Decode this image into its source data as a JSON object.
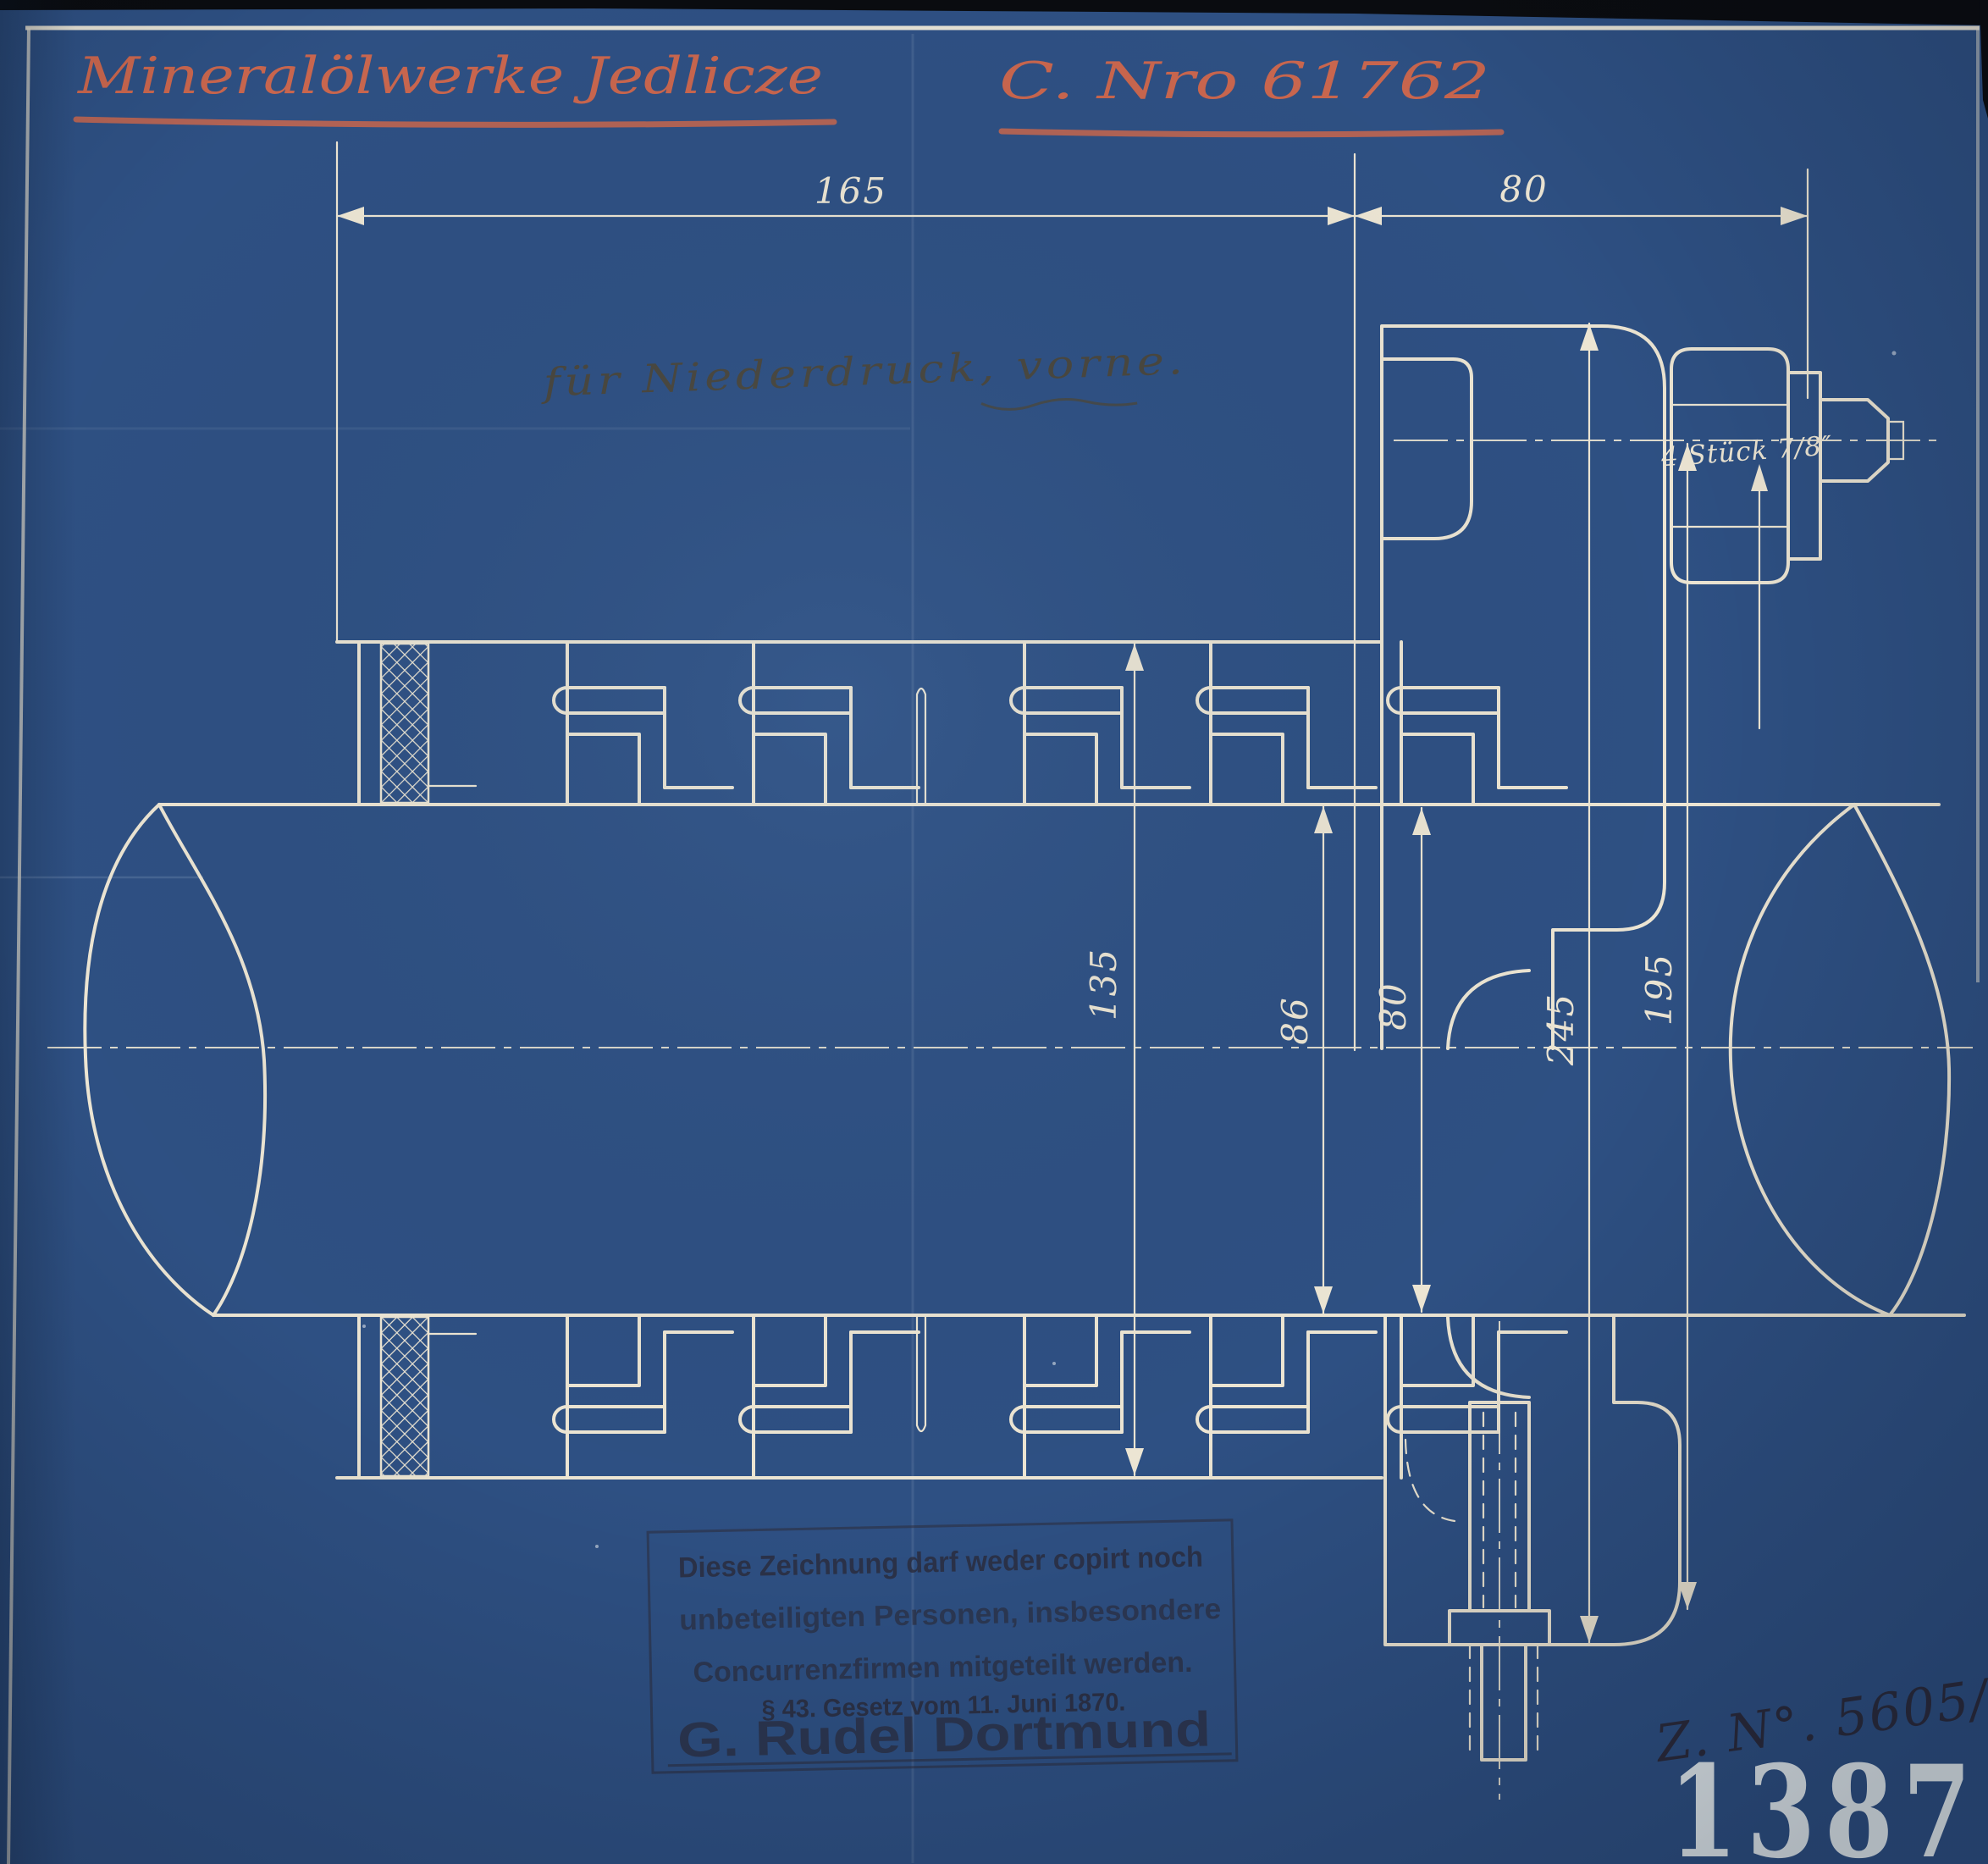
{
  "title": {
    "company": "Mineralölwerke Jedlicze",
    "number": "C. Nro 61762"
  },
  "note": "für Niederdruck, vorne.",
  "dimensions": {
    "top_left": "165",
    "top_right": "80",
    "stack": [
      "135",
      "86",
      "80",
      "245",
      "195"
    ],
    "bolt_label": "4 Stück 7/8″"
  },
  "stamp": {
    "line1": "Diese Zeichnung darf weder copirt noch",
    "line2": "unbeteiligten Personen, insbesondere",
    "line3": "Concurrenzfirmen mitgeteilt werden.",
    "line4": "§ 43. Gesetz vom 11. Juni 1870.",
    "name": "G. Rudel Dortmund"
  },
  "annotations": {
    "drawing_number": "Z. N°. 5605/½",
    "archive_number": "1387"
  },
  "colors": {
    "paper": "#2e5083",
    "line": "#ece5d3",
    "red": "#c9664e",
    "pencil": "#4c4636",
    "ink": "#2b2733"
  }
}
